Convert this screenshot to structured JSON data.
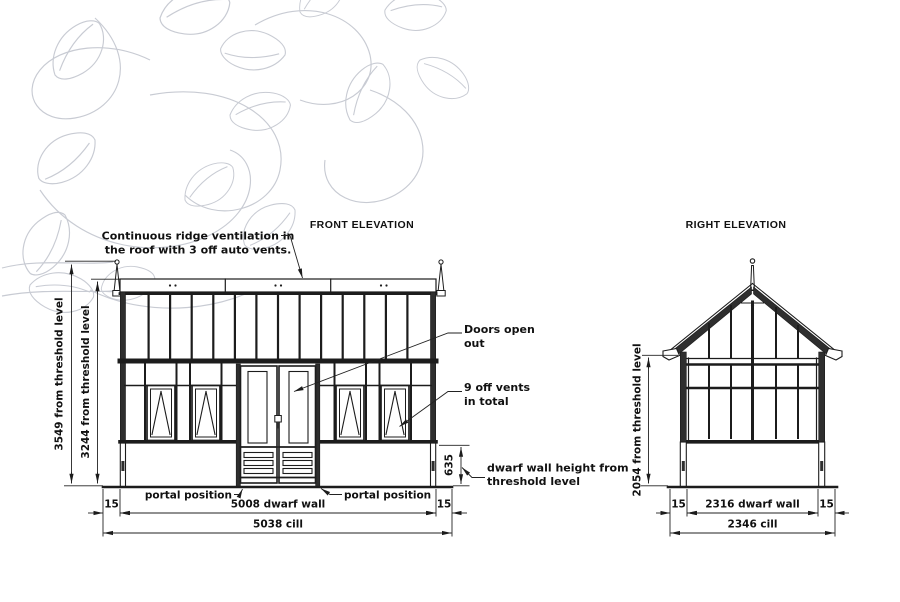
{
  "titles": {
    "front": "FRONT ELEVATION",
    "right": "RIGHT ELEVATION"
  },
  "annotations": {
    "ridge_line1": "Continuous ridge ventilation in",
    "ridge_line2": "the roof with 3 off auto vents.",
    "doors_line1": "Doors open",
    "doors_line2": "out",
    "vents_line1": "9 off vents",
    "vents_line2": "in total",
    "dwarf_line1": "dwarf wall height from",
    "dwarf_line2": "threshold level",
    "portal_left": "portal position",
    "portal_right": "portal position"
  },
  "front_dims": {
    "overall_height": "3549 from threshold level",
    "ridge_height": "3244 from threshold level",
    "dwarf_wall_height": "635",
    "left_offset": "15",
    "right_offset": "15",
    "dwarf_wall_width": "5008 dwarf wall",
    "cill_width": "5038 cill"
  },
  "right_dims": {
    "eaves_height": "2054 from threshold level",
    "left_offset": "15",
    "right_offset": "15",
    "dwarf_wall_width": "2316 dwarf wall",
    "cill_width": "2346 cill"
  },
  "colors": {
    "line": "#1c1c1c",
    "leaf_pattern": "#c8cbd3",
    "background": "#ffffff"
  }
}
